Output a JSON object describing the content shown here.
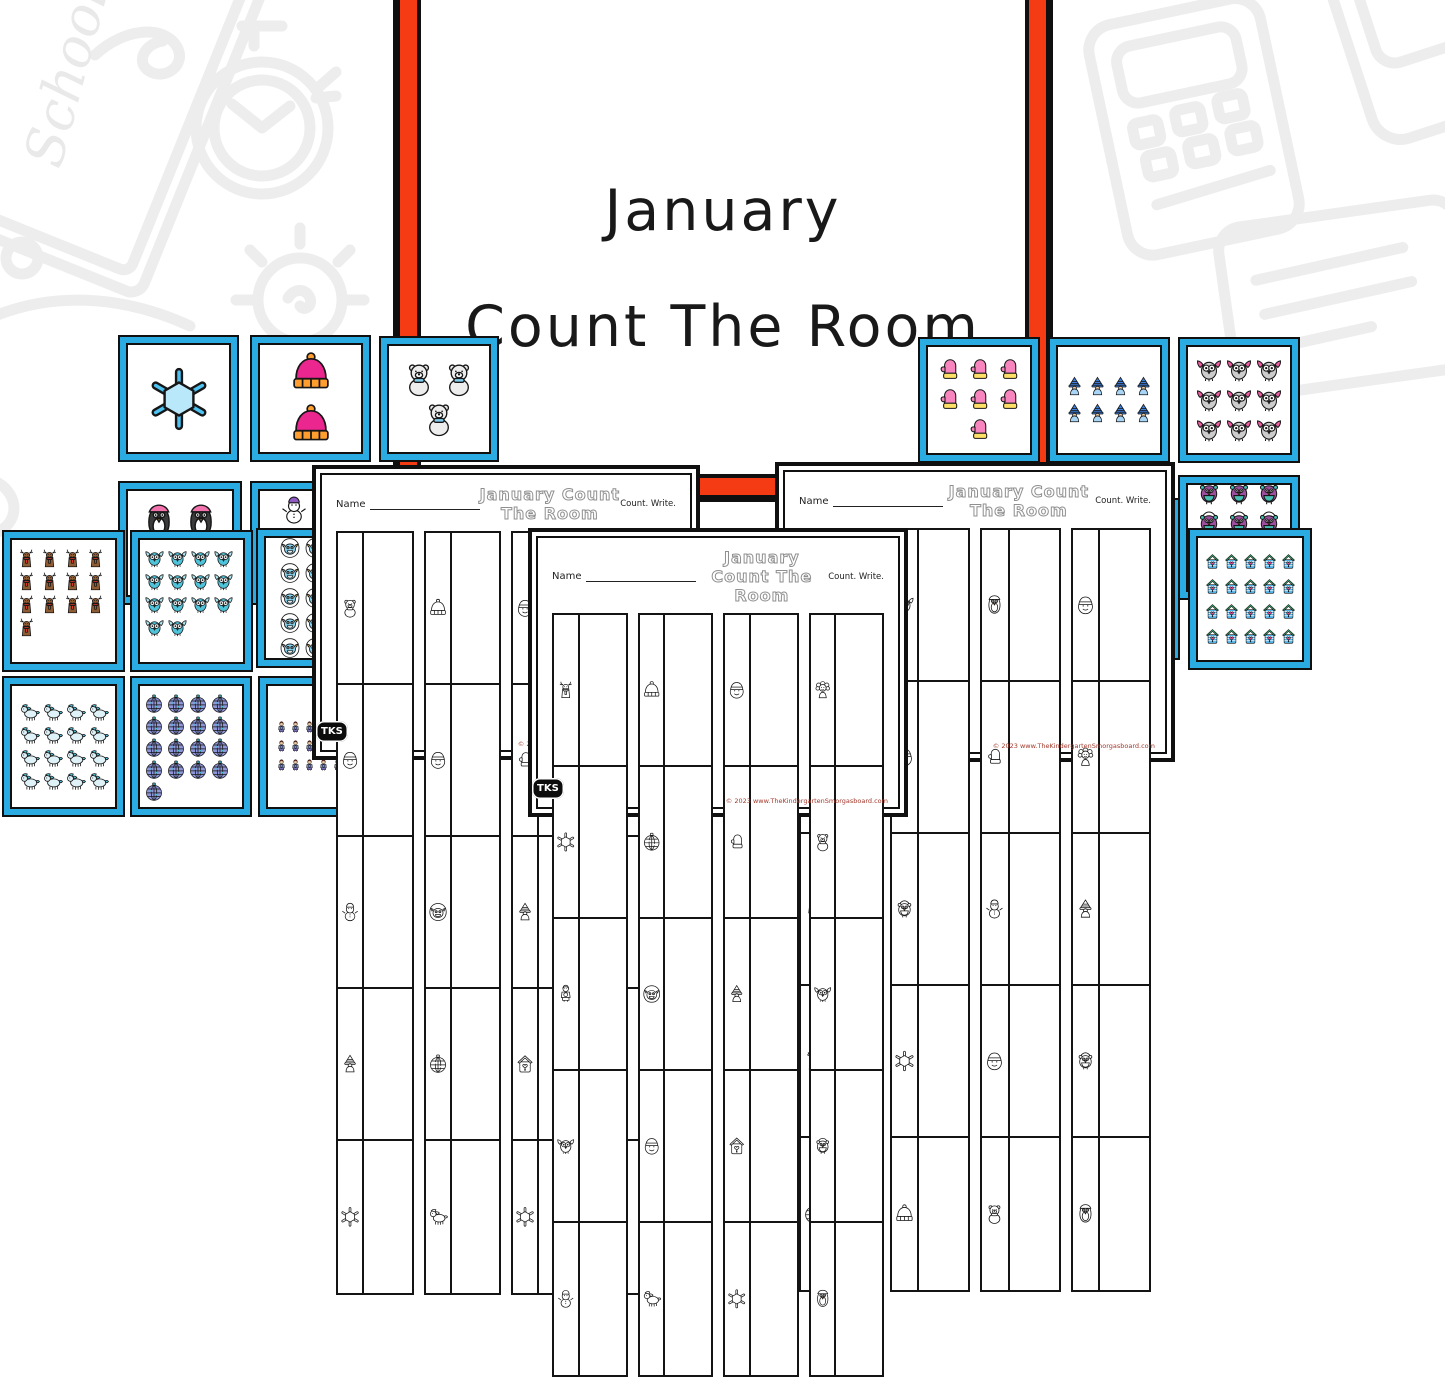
{
  "title_card": {
    "line1": "January",
    "line2": "Count The Room",
    "border_red": "#f43b14",
    "border_black": "#101010",
    "text_color": "#191919"
  },
  "branding": {
    "logo_text": "TKS",
    "copyright": "© 2023 www.TheKindergartenSmorgasboard.com"
  },
  "worksheet_template": {
    "name_label": "Name",
    "title": "January Count The Room",
    "instructions": "Count. Write."
  },
  "worksheets": [
    {
      "id": "left-worksheet",
      "columns": [
        [
          "bear",
          "snowman-face",
          "snowman",
          "gnome",
          "snowflake"
        ],
        [
          "hat",
          "snowman-face",
          "yeti",
          "ornament",
          "horse"
        ],
        [
          "snowman-face",
          "mitten",
          "gnome",
          "birdhouse",
          "snowflake"
        ],
        [
          "girl",
          "bear",
          "owl",
          "bird",
          "penguin"
        ]
      ]
    },
    {
      "id": "right-worksheet",
      "columns": [
        [
          "gnome",
          "snowman",
          "kid",
          "moose",
          "ornament"
        ],
        [
          "owl",
          "snowman-face",
          "bird",
          "snowflake",
          "hat"
        ],
        [
          "penguin",
          "mitten",
          "snowman",
          "snowman-face",
          "bear"
        ],
        [
          "snowman-face",
          "girl",
          "gnome",
          "bird",
          "penguin"
        ]
      ]
    },
    {
      "id": "center-worksheet",
      "columns": [
        [
          "moose",
          "snowflake",
          "kid",
          "owl",
          "snowman"
        ],
        [
          "hat",
          "ornament",
          "yeti",
          "snowman-face",
          "horse"
        ],
        [
          "snowman-face",
          "mitten",
          "gnome",
          "birdhouse",
          "snowflake"
        ],
        [
          "girl",
          "bear",
          "owl",
          "bird",
          "penguin"
        ]
      ]
    }
  ],
  "count_cards": [
    {
      "id": "snowflake-1",
      "item": "snowflake",
      "symbol": "snowflake",
      "count": 1,
      "color": "#4ec3f2",
      "acc": "#b9e8fa"
    },
    {
      "id": "hats-2",
      "item": "winter hat",
      "symbol": "hat",
      "count": 2,
      "color": "#ec268f",
      "acc": "#ff9d2e"
    },
    {
      "id": "bears-3",
      "item": "polar bear",
      "symbol": "bear",
      "count": 3,
      "color": "#ededed",
      "acc": "#7fcdee"
    },
    {
      "id": "penguins-4",
      "item": "penguin",
      "symbol": "penguin",
      "count": 4,
      "color": "#3b3b3b",
      "acc": "#f273ae",
      "partially_covered": true
    },
    {
      "id": "snowmen-5",
      "item": "snowman",
      "symbol": "snowman",
      "count": 5,
      "color": "#ffffff",
      "acc": "#8e5bc2",
      "partially_covered": true
    },
    {
      "id": "mittens-7",
      "item": "mitten",
      "symbol": "mitten",
      "count": 7,
      "color": "#f985bf",
      "acc": "#ffe066"
    },
    {
      "id": "gnomes-8",
      "item": "gnome",
      "symbol": "gnome",
      "count": 8,
      "color": "#3c7ed9",
      "acc": "#a8d4f5"
    },
    {
      "id": "grays-9",
      "item": "gray bird",
      "symbol": "owl",
      "count": 9,
      "color": "#cccccc",
      "acc": "#ef5ba1"
    },
    {
      "id": "birds-10",
      "item": "earmuff bird",
      "symbol": "bird",
      "count": 10,
      "color": "#9c4f9e",
      "acc": "#45c0b4",
      "partially_covered": true
    },
    {
      "id": "moose-13",
      "item": "moose",
      "symbol": "moose",
      "count": 13,
      "color": "#8f5b33",
      "acc": "#e23b2e"
    },
    {
      "id": "owls-14",
      "item": "owl",
      "symbol": "owl",
      "count": 14,
      "color": "#4fc3d9",
      "acc": "#aee6f0"
    },
    {
      "id": "yetis-15",
      "item": "yeti",
      "symbol": "yeti",
      "count": 15,
      "color": "#86d5f0",
      "acc": "#e8c84a",
      "partially_covered": true
    },
    {
      "id": "horses-16",
      "item": "winter pony",
      "symbol": "horse",
      "count": 16,
      "color": "#dff2f8",
      "acc": "#4fc3d9"
    },
    {
      "id": "ornaments-17",
      "item": "ornament",
      "symbol": "ornament",
      "count": 17,
      "color": "#8f96d9",
      "acc": "#45c0d4"
    },
    {
      "id": "kids-18",
      "item": "kid",
      "symbol": "kid",
      "count": 18,
      "color": "#7b8fd6",
      "acc": "#c62f2f",
      "partially_covered": true
    },
    {
      "id": "birdhouses-20",
      "item": "birdhouse",
      "symbol": "birdhouse",
      "count": 20,
      "color": "#4fb0e6",
      "acc": "#3cb878"
    },
    {
      "id": "hidden-card",
      "item": "hidden card",
      "symbol": "none",
      "count": 0,
      "color": "#ffffff",
      "acc": "#ffffff",
      "partially_covered": true
    }
  ],
  "card_style": {
    "border_blue": "#2aace2",
    "border_black": "#101010"
  },
  "doodles": {
    "school_text": "School",
    "color": "#ededed",
    "shapes": [
      "notebook",
      "school-script",
      "stopwatch",
      "lightbulb",
      "calculator",
      "phone",
      "notepad",
      "scribble"
    ]
  }
}
